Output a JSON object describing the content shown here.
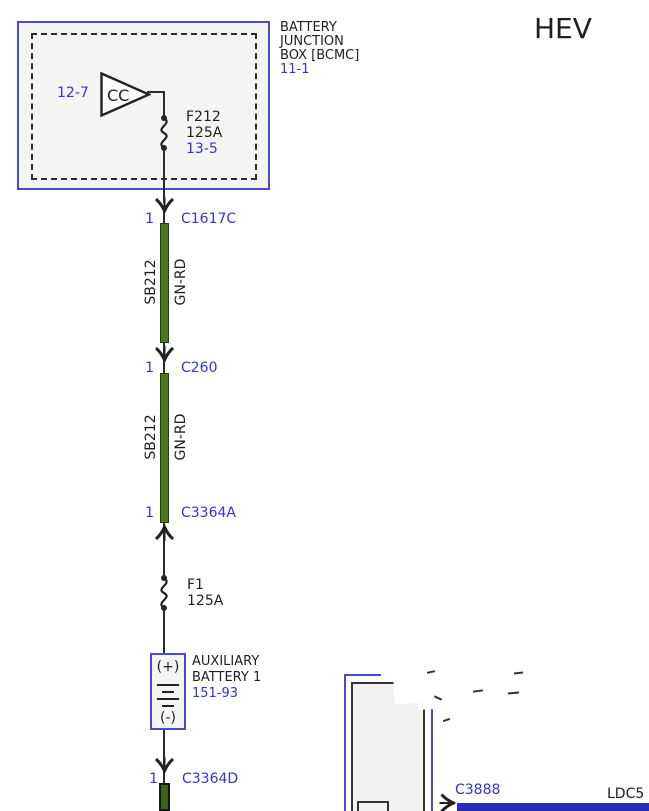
{
  "header": {
    "vehicle_label": "HEV"
  },
  "battery_junction_box": {
    "title_line1": "BATTERY",
    "title_line2": "JUNCTION",
    "title_line3": "BOX [BCMC]",
    "page_ref": "11-1",
    "breaker_ref": "12-7",
    "breaker_label": "CC",
    "fuse_name": "F212",
    "fuse_rating": "125A",
    "fuse_ref": "13-5"
  },
  "connectors": {
    "c1617c": {
      "pin": "1",
      "label": "C1617C"
    },
    "c260": {
      "pin": "1",
      "label": "C260"
    },
    "c3364a": {
      "pin": "1",
      "label": "C3364A"
    },
    "c3364d": {
      "pin": "1",
      "label": "C3364D"
    },
    "c3888": {
      "label": "C3888"
    }
  },
  "wires": {
    "segment1": {
      "circuit": "SB212",
      "color_code": "GN-RD"
    },
    "segment2": {
      "circuit": "SB212",
      "color_code": "GN-RD"
    }
  },
  "fuse_f1": {
    "name": "F1",
    "rating": "125A"
  },
  "aux_battery": {
    "positive": "(+)",
    "negative": "(-)",
    "title_line1": "AUXILIARY",
    "title_line2": "BATTERY 1",
    "page_ref": "151-93"
  },
  "bottom_module": {
    "net_label": "LDC5"
  },
  "colors": {
    "link_blue": "#3535cd",
    "component_border_blue": "#4a4ad2",
    "wire_green": "#4a7a1f",
    "bus_bar_blue": "#2b2bb5",
    "box_fill": "#f4f4f2",
    "wire_black": "#2b2b2b"
  }
}
